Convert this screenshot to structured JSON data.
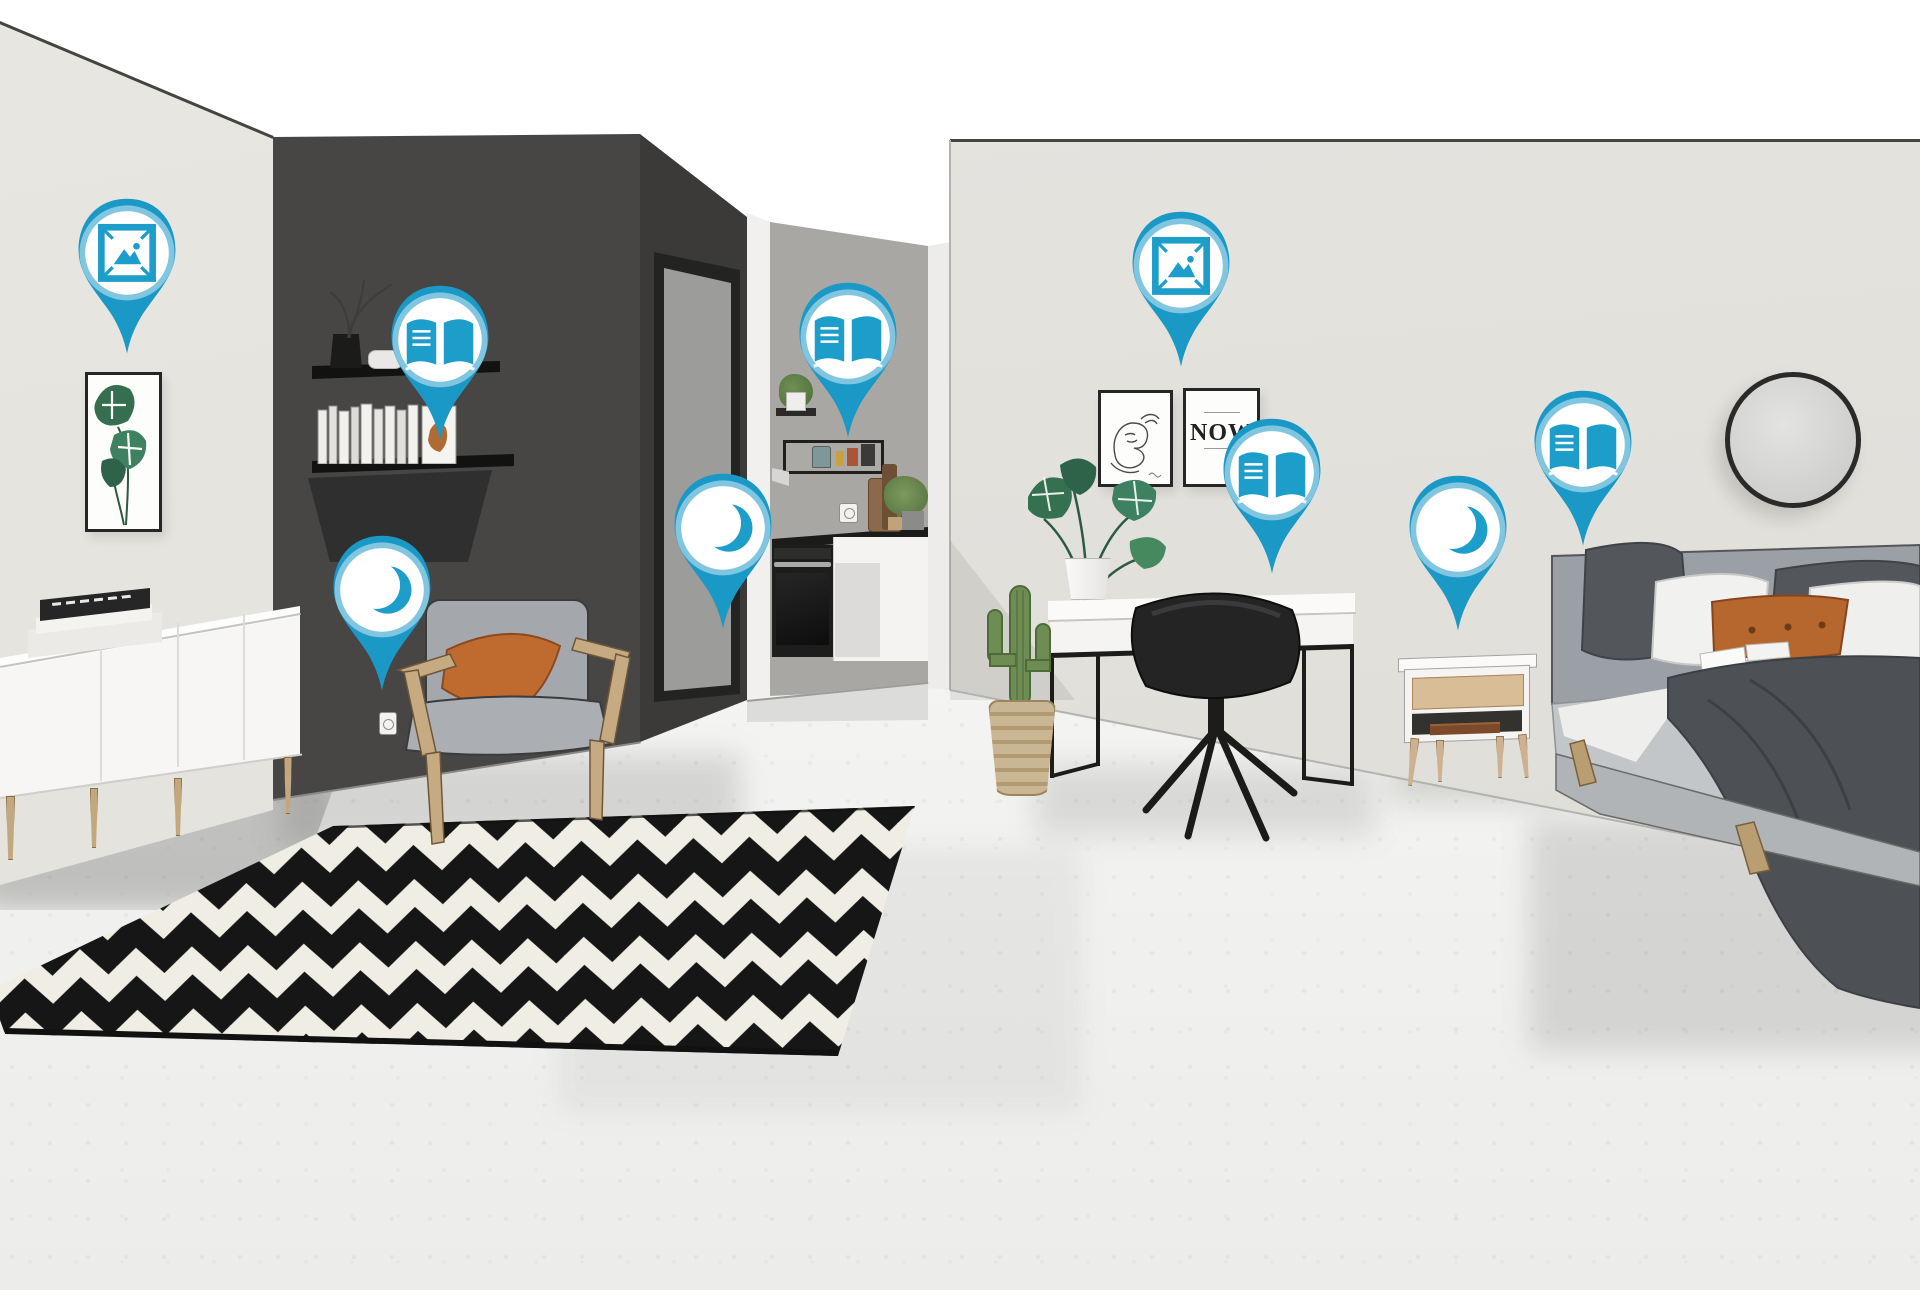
{
  "scene": {
    "title": "studio-apartment-3d-scene-with-hotspots",
    "rooms": [
      "living-area",
      "kitchen-nook",
      "bedroom-area"
    ]
  },
  "poster": {
    "text": "NOW"
  },
  "colors": {
    "pin_body": "#1a98c6",
    "pin_icon": "#1d9dca",
    "pin_glow": "#ffffff",
    "dark_wall": "#474645",
    "dark_wall_side": "#3b3a39",
    "light_wall": "#e6e4df",
    "bedroom_wall": "#e3e1dc",
    "kitchen_wall": "#a9a7a4",
    "floor": "#f2f2f0",
    "rug_black": "#161616",
    "rug_white": "#f0eee4",
    "accent_orange": "#bf6b2f",
    "upholstery_gray": "#a4a8ac",
    "wood": "#c6ab82"
  },
  "icon_names": {
    "picture": "picture-frame-icon",
    "book": "open-book-icon",
    "moon": "moon-icon"
  },
  "pins": [
    {
      "icon": "picture",
      "label": "living-room-wall-art",
      "x": 127,
      "y": 253
    },
    {
      "icon": "book",
      "label": "wall-shelf-books",
      "x": 440,
      "y": 340
    },
    {
      "icon": "moon",
      "label": "armchair-corner",
      "x": 382,
      "y": 590
    },
    {
      "icon": "moon",
      "label": "hallway-doorway",
      "x": 723,
      "y": 528
    },
    {
      "icon": "book",
      "label": "kitchen-shelves",
      "x": 848,
      "y": 337
    },
    {
      "icon": "picture",
      "label": "bedroom-wall-art",
      "x": 1181,
      "y": 266
    },
    {
      "icon": "book",
      "label": "desk-area",
      "x": 1272,
      "y": 473
    },
    {
      "icon": "moon",
      "label": "nightstand",
      "x": 1458,
      "y": 530
    },
    {
      "icon": "book",
      "label": "bed",
      "x": 1583,
      "y": 445
    }
  ]
}
